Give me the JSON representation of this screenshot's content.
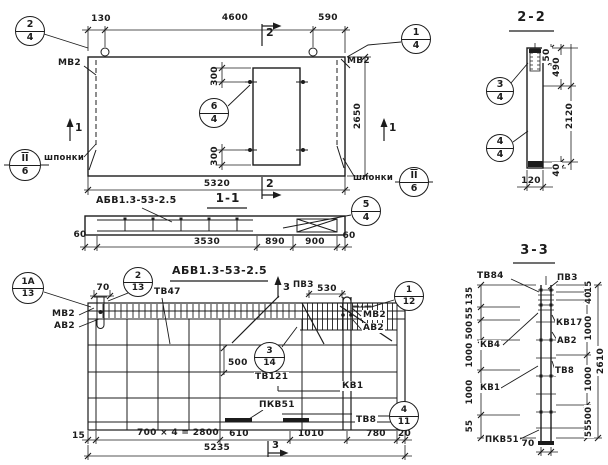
{
  "top_view": {
    "dim_130": "130",
    "dim_4600": "4600",
    "dim_590": "590",
    "dim_300_top": "300",
    "dim_300_bottom": "300",
    "dim_2650": "2650",
    "dim_5320": "5320",
    "label_mv2_left": "МВ2",
    "label_mv2_right": "МВ2",
    "label_shponki_left": "шпонки",
    "label_shponki_right": "шпонки",
    "mark_section2_top": "2",
    "mark_section2_bottom": "2",
    "mark_section1_left": "1",
    "mark_section1_right": "1",
    "callout_2_4": {
      "top": "2",
      "bottom": "4"
    },
    "callout_1_4": {
      "top": "1",
      "bottom": "4"
    },
    "callout_6_4": {
      "top": "6",
      "bottom": "4"
    },
    "callout_ii_6_left": {
      "top": "II",
      "bottom": "6"
    },
    "callout_ii_6_right": {
      "top": "II",
      "bottom": "6"
    }
  },
  "section_1_1": {
    "title": "1-1",
    "panel_mark": "АБВ1.3-53-2.5",
    "dim_60_left": "60",
    "dim_3530": "3530",
    "dim_890": "890",
    "dim_900": "900",
    "dim_60_right": "60",
    "callout_5_4": {
      "top": "5",
      "bottom": "4"
    }
  },
  "plan_view": {
    "title": "АБВ1.3-53-2.5",
    "dim_70": "70",
    "dim_530": "530",
    "dim_500": "500",
    "dim_15": "15",
    "dim_700x4": "700 × 4 = 2800",
    "dim_610": "610",
    "dim_1010": "1010",
    "dim_780": "780",
    "dim_20": "20",
    "dim_5235": "5235",
    "label_tv47": "ТВ47",
    "label_pv3": "ПВЗ",
    "label_mv2_left": "МВ2",
    "label_av2_left": "АВ2",
    "label_mv2_right": "МВ2",
    "label_av2_right": "АВ2",
    "label_tv121": "ТВ121",
    "label_kv1": "КВ1",
    "label_pkv51": "ПКВ51",
    "label_tv8": "ТВ8",
    "mark_section3_top": "3",
    "mark_section3_bottom": "3",
    "callout_1a_13": {
      "top": "1А",
      "bottom": "13"
    },
    "callout_2_13": {
      "top": "2",
      "bottom": "13"
    },
    "callout_1_12": {
      "top": "1",
      "bottom": "12"
    },
    "callout_3_14": {
      "top": "3",
      "bottom": "14"
    },
    "callout_4_11": {
      "top": "4",
      "bottom": "11"
    }
  },
  "section_2_2": {
    "title": "2-2",
    "dim_50": "50",
    "dim_490": "490",
    "dim_2120": "2120",
    "dim_40": "40",
    "dim_120": "120",
    "callout_3_4": {
      "top": "3",
      "bottom": "4"
    },
    "callout_4_4": {
      "top": "4",
      "bottom": "4"
    }
  },
  "section_3_3": {
    "title": "3-3",
    "label_tv84": "ТВ84",
    "label_pv3": "ПВЗ",
    "label_kv17": "КВ17",
    "label_av2": "АВ2",
    "label_tv8": "ТВ8",
    "label_kv4": "КВ4",
    "label_kv1": "КВ1",
    "label_pkv51": "ПКВ51",
    "dim_135": "135",
    "dim_55_top": "55",
    "dim_500_left": "500",
    "dim_1000_left_a": "1000",
    "dim_1000_left_b": "1000",
    "dim_55_bottom_left": "55",
    "dim_15": "15",
    "dim_40": "40",
    "dim_1000_right_a": "1000",
    "dim_1000_right_b": "1000",
    "dim_500_right": "500",
    "dim_55_right": "55",
    "dim_2610": "2610",
    "dim_70": "70"
  }
}
